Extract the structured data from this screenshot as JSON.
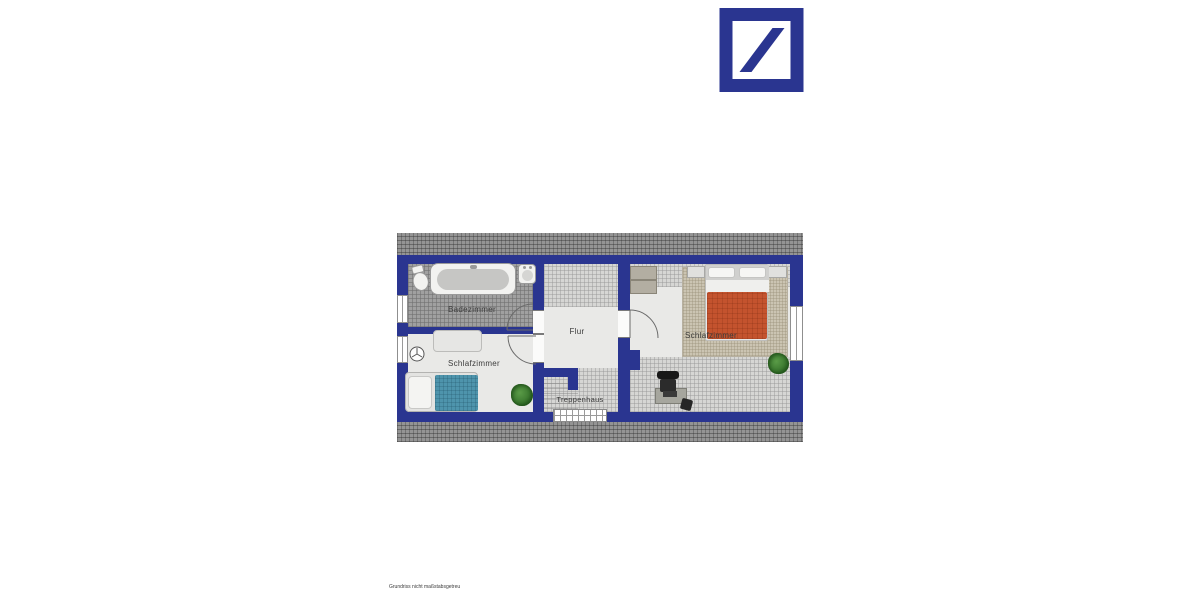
{
  "logo": {
    "name": "Deutsche Bank logo",
    "color": "#2a3590"
  },
  "floorplan": {
    "title": "Dachgeschoss Grundriss",
    "rooms": {
      "bathroom": {
        "label": "Badezimmer"
      },
      "bedroom_left": {
        "label": "Schlafzimmer"
      },
      "hallway": {
        "label": "Flur"
      },
      "staircase": {
        "label": "Treppenhaus"
      },
      "bedroom_right": {
        "label": "Schlafzimmer"
      }
    },
    "colors": {
      "wall": "#2a3590",
      "roof_hatch": "#949494",
      "bathroom_tile": "#a0a0a0",
      "floor": "#e9e9e7",
      "slope_hatch": "#d6d6d4",
      "carpet": "#cbc4b2",
      "bed_left_blanket": "#4e94ac",
      "bed_right_blanket": "#c4532e",
      "plant_green": "#3f7a33"
    }
  },
  "footer": {
    "disclaimer": "Grundriss nicht maßstabsgetreu"
  }
}
